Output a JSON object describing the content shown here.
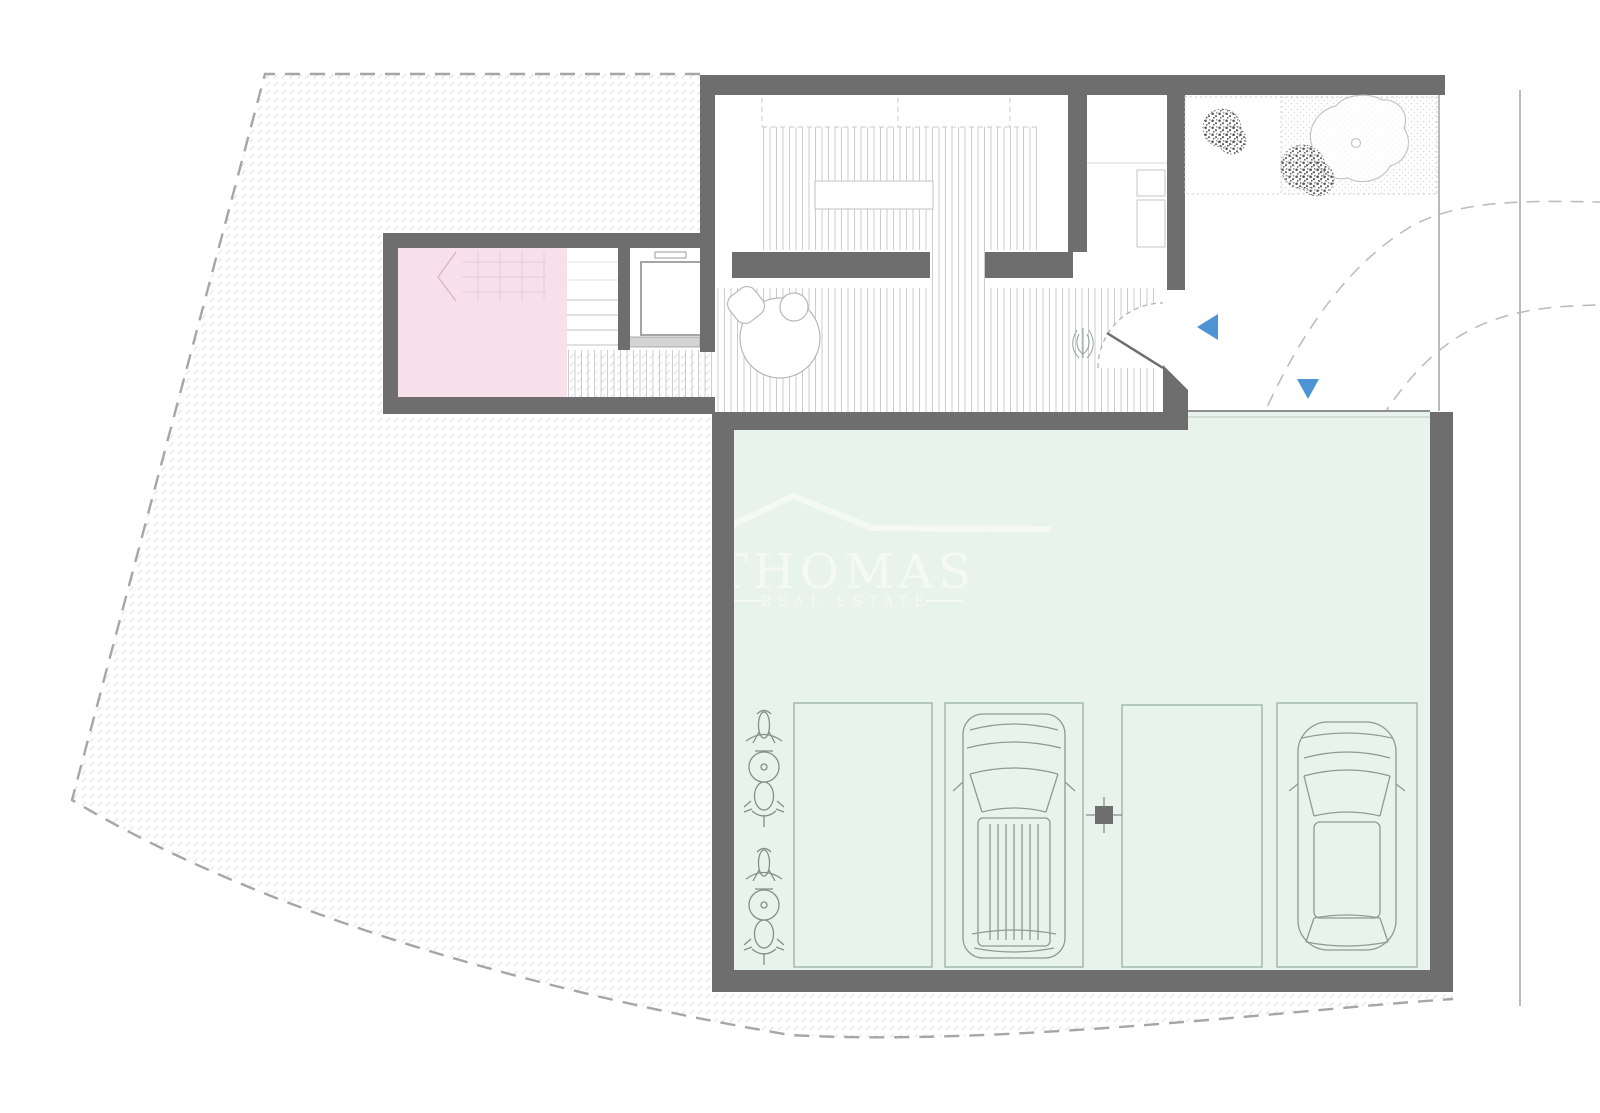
{
  "watermark": {
    "brand": "THOMAS",
    "tagline": "REAL ESTATE"
  },
  "colors": {
    "background": "#ffffff",
    "wall": "#6e6e6e",
    "pink_room": "#f7e0e9",
    "garage_floor": "#e9f3ed",
    "parking_line": "#93ab9e",
    "vehicle_line": "#8a9d92",
    "deck_hatch_line": "#cdcdcd",
    "plot_hatch_line": "#e0e0e0",
    "boundary_dash": "#a6a6a6",
    "arrow_blue": "#4e93d3",
    "tree_outline": "#c5c5c5",
    "bush_stipple": "#555555",
    "watermark_white": "#ffffff",
    "road_line": "#a8a8a8"
  },
  "annotations": {
    "entrance_arrow_direction": "left",
    "driveway_arrow_direction": "down"
  },
  "inventory": {
    "parking_spaces": 4,
    "cars": 2,
    "motorcycles": 2,
    "garden_bushes": 2,
    "garden_trees": 1,
    "structural_columns": 1
  }
}
